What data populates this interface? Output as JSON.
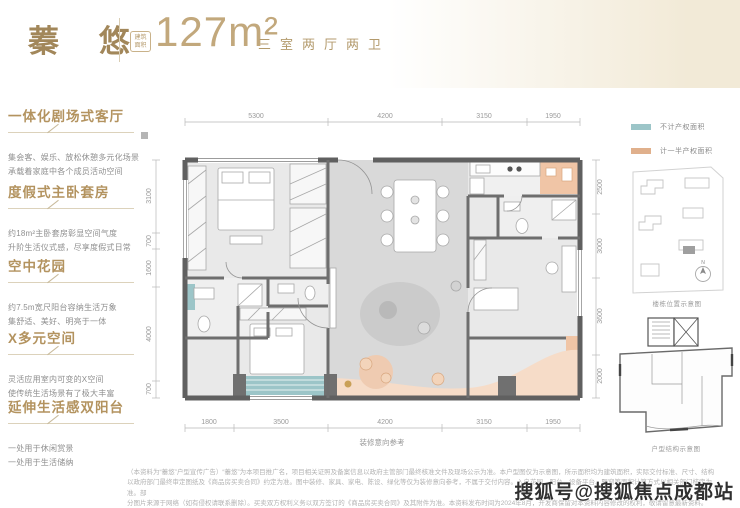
{
  "colors": {
    "accent_gold": "#b3935f",
    "light_gold": "#c2a87c",
    "teal_highlight": "#9cc5c8",
    "peach_highlight": "#eec3a3",
    "wall_gray": "#606060",
    "body_text_gray": "#8f8f8f"
  },
  "header": {
    "title": "蓁 悠",
    "badge_line1": "建筑",
    "badge_line2": "面积",
    "area_value": "127m²",
    "layout_label": "三室两厅两卫"
  },
  "sidebar": {
    "sections": [
      {
        "heading": "一体化剧场式客厅",
        "line1": "集会客、娱乐、放松休憩多元化场景",
        "line2": "承载着家庭中各个成员活动空间"
      },
      {
        "heading": "度假式主卧套房",
        "line1": "约18m²主卧套房彰显空间气度",
        "line2": "升阶生活仪式感，尽享度假式日常"
      },
      {
        "heading": "空中花园",
        "line1": "约7.5m宽尺阳台容纳生活万象",
        "line2": "集舒适、美好、明亮于一体"
      },
      {
        "heading": "X多元空间",
        "line1": "灵活应用室内可变的X空间",
        "line2": "使传统生活场景有了极大丰富"
      },
      {
        "heading": "延伸生活感双阳台",
        "line1": "一处用于休闲赏景",
        "line2": "一处用于生活储纳"
      }
    ]
  },
  "plan": {
    "dims_top": [
      "5300",
      "4200",
      "3150",
      "1950"
    ],
    "dims_bottom": [
      "1800",
      "3500",
      "4200",
      "3150",
      "1950"
    ],
    "dims_left": [
      "3100",
      "700",
      "1600",
      "4000",
      "700"
    ],
    "dims_right": [
      "2500",
      "3000",
      "3600",
      "2000"
    ],
    "caption": "装修意向参考"
  },
  "legend": {
    "items": [
      {
        "label": "不计产权面积",
        "color": "#9cc5c8"
      },
      {
        "label": "计一半产权面积",
        "color": "#e0b08c"
      }
    ]
  },
  "diagrams": {
    "site_caption": "楼栋位置示意图",
    "unit_caption": "户型结构示意图",
    "north_label": "N"
  },
  "footer": {
    "lines": [
      "（本资料为“蓁悠”户型宣传广告）“蓁悠”为本项目推广名，项目相关证照及备案信息以政府主管部门最终核准文件及现场公示为准。本户型图仅为示意图，所示面积均为建筑面积，实际交付标准、尺寸、结构",
      "以政府部门最终审定图纸及《商品房买卖合同》约定为准。图中装修、家具、家电、陈设、绿化等仅为装修意向参考，不属于交付内容。入户花园、阳台、设备平台、飘窗等面积计算方式以相关部门核定为准。部",
      "分图片来源于网络（如有侵权请联系删除）。买卖双方权利义务以双方签订的《商品房买卖合同》及其附件为准。本资料发布时间为2024年8月，开发商保留对本资料内容修改的权利，敬请留意最新资料。",
      "2024年8月。本资料所载内容仅供参考，最终以政府最终批准文件为准。"
    ],
    "watermark": "搜狐号@搜狐焦点成都站"
  }
}
